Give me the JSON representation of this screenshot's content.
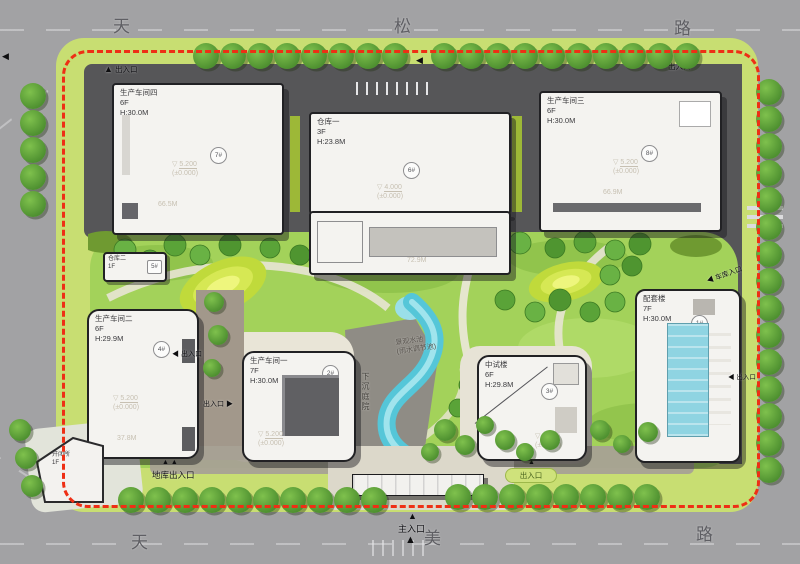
{
  "roads": {
    "top": [
      "天",
      "松",
      "路"
    ],
    "bottom": [
      "天",
      "美",
      "路"
    ]
  },
  "entrances": {
    "top_left": "出入口",
    "top_right": "出入口",
    "west_mid": "出入口",
    "west_low": "出入口",
    "east_garage": "车库入口",
    "east_mid": "出入口",
    "south_garage": "地库出入口",
    "main": "主入口",
    "south_badge": "出入口"
  },
  "features": {
    "water_title": "景观水池",
    "water_sub": "(雨水调节池)",
    "sunken_court": "下沉庭院"
  },
  "buildings": {
    "workshop4": {
      "name": "生产车间四",
      "floors": "6F",
      "height": "H:30.0M",
      "tag": "7#",
      "elev": "5.200",
      "datum": "(±0.000)",
      "dim": "66.5M"
    },
    "warehouse1": {
      "name": "仓库一",
      "floors": "3F",
      "height": "H:23.8M",
      "tag": "6#",
      "elev": "4.000",
      "datum": "(±0.000)",
      "dim": "72.9M"
    },
    "workshop3": {
      "name": "生产车间三",
      "floors": "6F",
      "height": "H:30.0M",
      "tag": "8#",
      "elev": "5.200",
      "datum": "(±0.000)",
      "dim": "66.9M"
    },
    "warehouse2": {
      "name": "仓库二",
      "floors": "1F",
      "tag": "5#"
    },
    "workshop2": {
      "name": "生产车间二",
      "floors": "6F",
      "height": "H:29.9M",
      "tag": "4#",
      "elev": "5.200",
      "datum": "(±0.000)",
      "dim": "37.8M"
    },
    "workshop1": {
      "name": "生产车间一",
      "floors": "7F",
      "height": "H:30.0M",
      "tag": "2#",
      "elev": "5.200",
      "datum": "(±0.000)"
    },
    "pilot": {
      "name": "中试楼",
      "floors": "6F",
      "height": "H:29.8M",
      "tag": "3#",
      "elev": "5.200",
      "datum": "(±0.000)"
    },
    "support": {
      "name": "配套楼",
      "floors": "7F",
      "height": "H:30.0M",
      "tag": "1#"
    },
    "switch_station": {
      "name": "开闭所",
      "floors": "1F"
    }
  },
  "icons": {
    "arrow_up": "▲",
    "arrow_left": "◀",
    "arrow_right": "▶",
    "elev_mark": "▽",
    "double_up": "▲ ▲"
  },
  "colors": {
    "boundary": "#ee2f15",
    "water": "#55c6d8",
    "park": "#a3d25a",
    "asphalt": "#565658",
    "road": "#a2a2a4"
  }
}
